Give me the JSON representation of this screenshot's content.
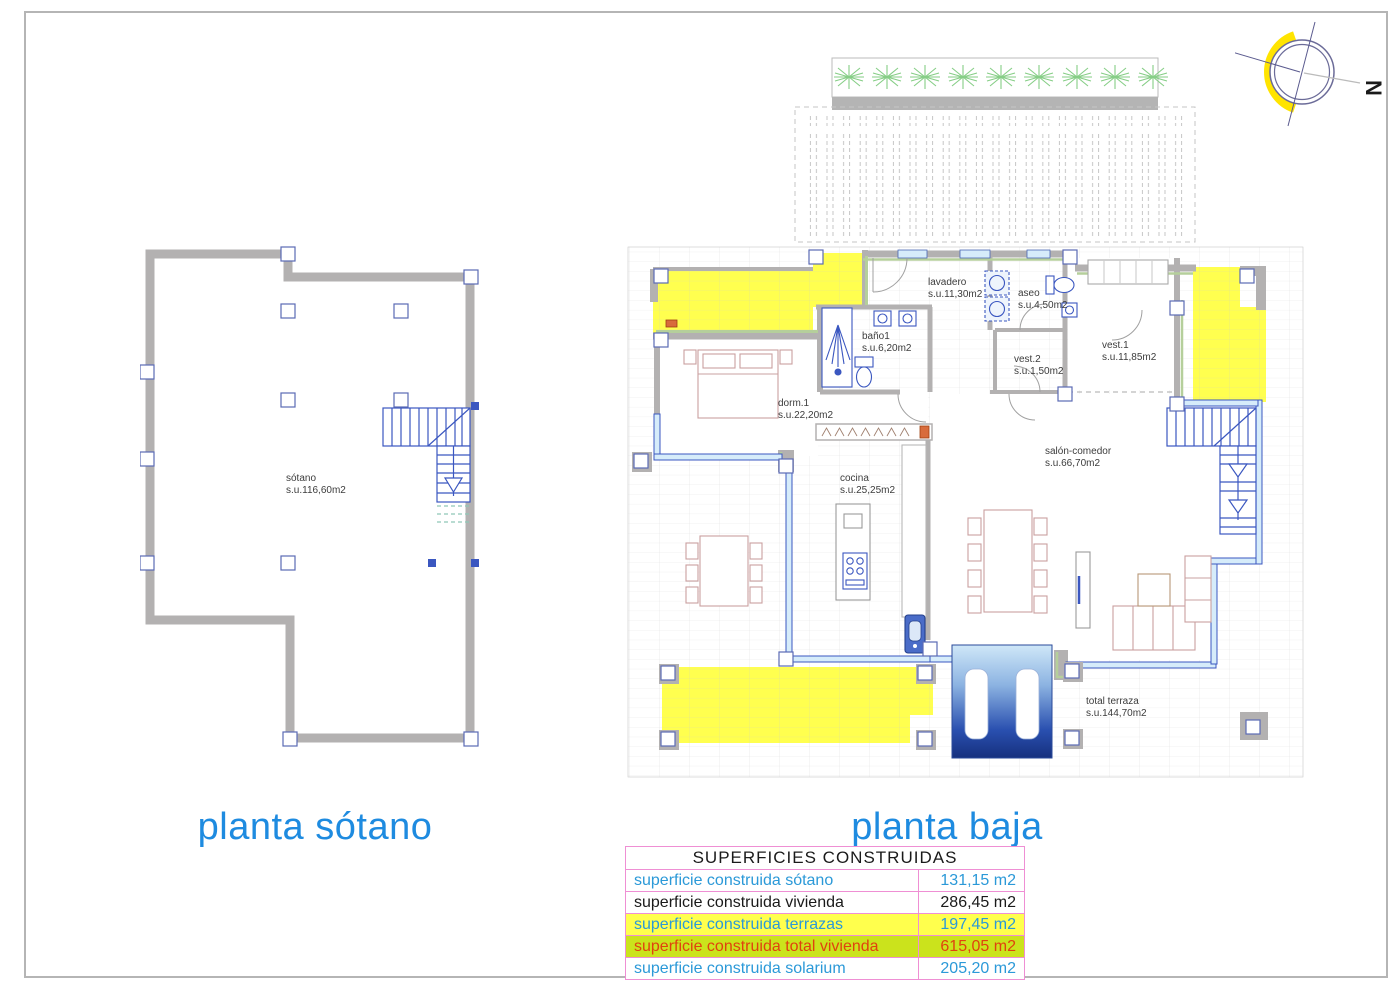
{
  "page": {
    "background": "#ffffff",
    "frame_color": "#b5b5b5"
  },
  "titles": {
    "basement": "planta sótano",
    "ground": "planta baja",
    "color": "#1e8be0"
  },
  "compass": {
    "north": "N"
  },
  "basement_plan": {
    "title": "planta sótano",
    "rooms": [
      {
        "name": "sótano",
        "area": "s.u.116,60m2"
      }
    ]
  },
  "ground_plan": {
    "title": "planta baja",
    "rooms": [
      {
        "name": "lavadero",
        "area": "s.u.11,30m2"
      },
      {
        "name": "aseo",
        "area": "s.u.4,50m2"
      },
      {
        "name": "baño1",
        "area": "s.u.6,20m2"
      },
      {
        "name": "vest.2",
        "area": "s.u.1,50m2"
      },
      {
        "name": "vest.1",
        "area": "s.u.11,85m2"
      },
      {
        "name": "dorm.1",
        "area": "s.u.22,20m2"
      },
      {
        "name": "cocina",
        "area": "s.u.25,25m2"
      },
      {
        "name": "salón-comedor",
        "area": "s.u.66,70m2"
      },
      {
        "name": "total terraza",
        "area": "s.u.144,70m2"
      }
    ]
  },
  "areas_table": {
    "title": "SUPERFICIES CONSTRUIDAS",
    "border_color": "#ef8fd4",
    "rows": [
      {
        "label": "superficie construida sótano",
        "value": "131,15 m2",
        "text_color": "#2b99d8",
        "bg": "#ffffff"
      },
      {
        "label": "superficie construida vivienda",
        "value": "286,45 m2",
        "text_color": "#1a1a1a",
        "bg": "#ffffff"
      },
      {
        "label": "superficie construida terrazas",
        "value": "197,45 m2",
        "text_color": "#2b99d8",
        "bg": "#ffff4d"
      },
      {
        "label": "superficie construida total vivienda",
        "value": "615,05 m2",
        "text_color": "#e0420e",
        "bg": "#cbe31c"
      },
      {
        "label": "superficie construida solarium",
        "value": "205,20 m2",
        "text_color": "#2b99d8",
        "bg": "#ffffff"
      }
    ]
  },
  "colors": {
    "wall_gray": "#b3b1b1",
    "terrace_yellow": "#ffff4f",
    "glass_blue": "#3b57c0",
    "glass_fill": "#d6ecfa",
    "stair_blue": "#3b57c0",
    "green_lining": "#b5cf9b",
    "plant_green": "#86ce86",
    "pool_dark": "#16307e",
    "compass_yellow": "#ffe400"
  }
}
